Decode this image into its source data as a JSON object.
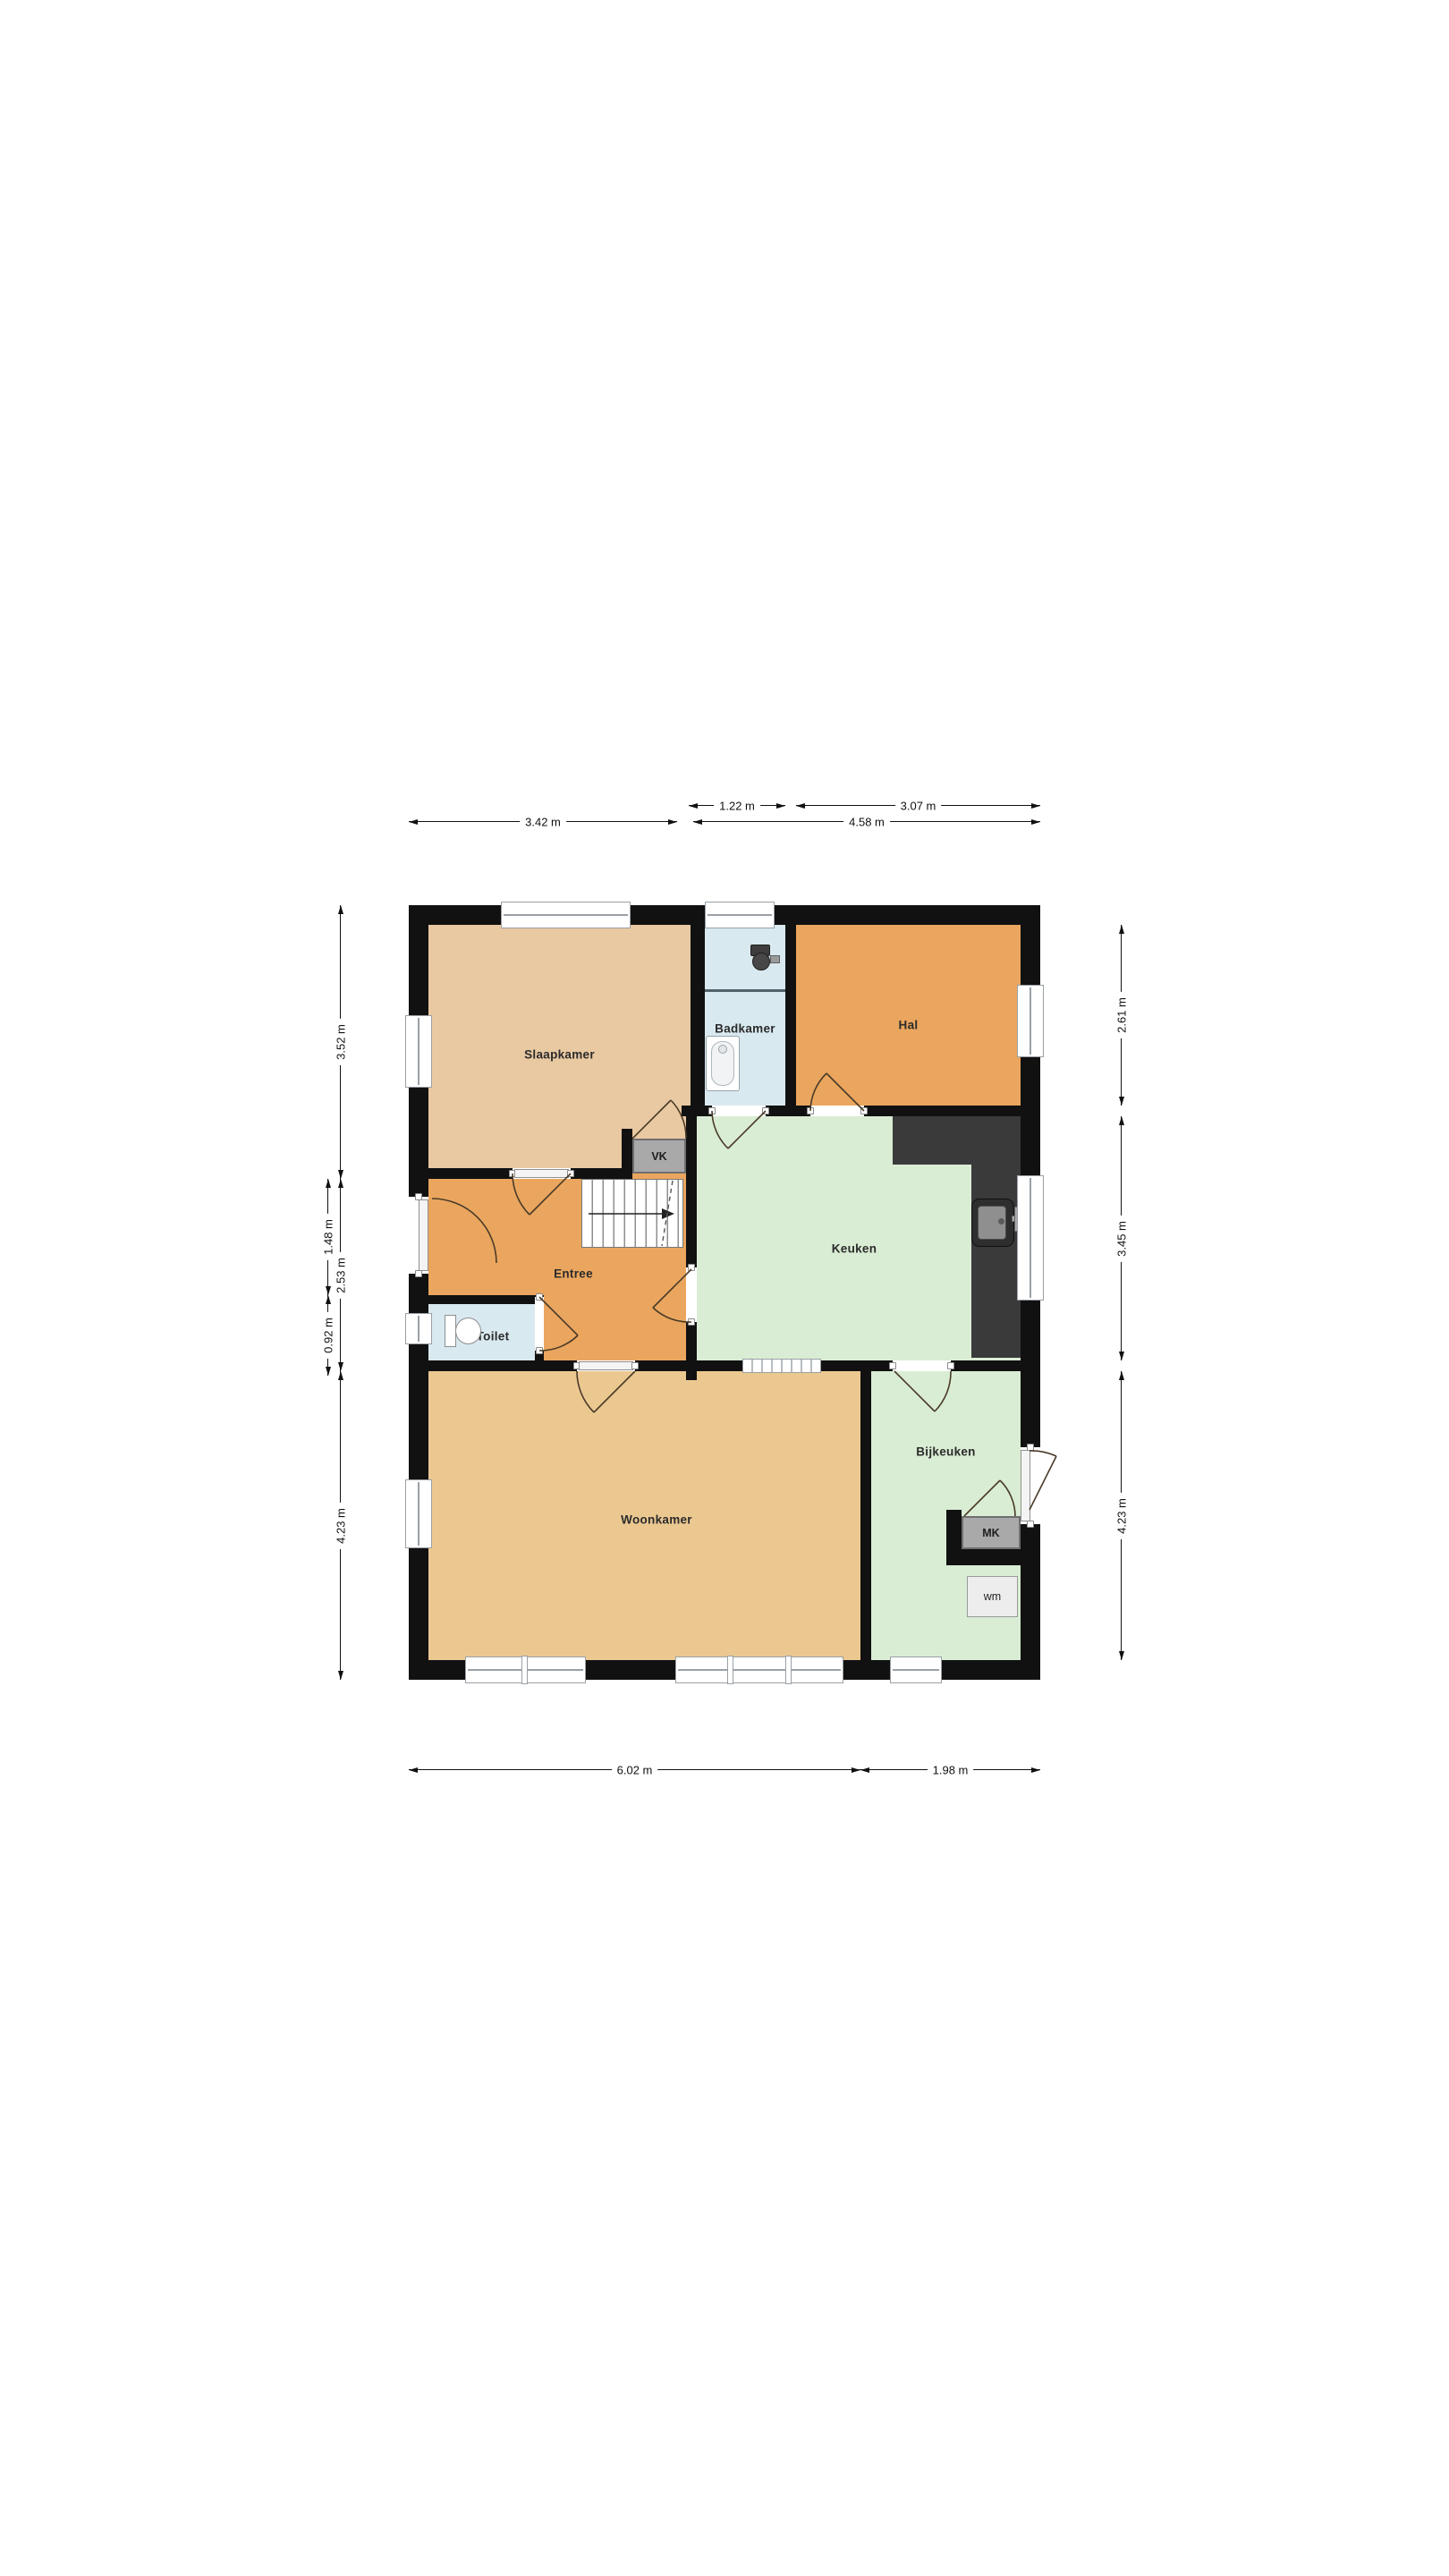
{
  "plan": {
    "kind": "floor-plan",
    "floor": "begane grond"
  },
  "rooms": {
    "slaapkamer": {
      "label": "Slaapkamer"
    },
    "badkamer": {
      "label": "Badkamer"
    },
    "hal": {
      "label": "Hal"
    },
    "keuken": {
      "label": "Keuken"
    },
    "entree": {
      "label": "Entree"
    },
    "toilet": {
      "label": "Toilet"
    },
    "woonkamer": {
      "label": "Woonkamer"
    },
    "bijkeuken": {
      "label": "Bijkeuken"
    }
  },
  "closets": {
    "vk": {
      "label": "VK"
    },
    "mk": {
      "label": "MK"
    },
    "wm": {
      "label": "wm"
    }
  },
  "dimensions": {
    "top": {
      "d122": "1.22 m",
      "d307": "3.07 m",
      "d342": "3.42 m",
      "d458": "4.58 m"
    },
    "left": {
      "d352": "3.52 m",
      "d148": "1.48 m",
      "d253": "2.53 m",
      "d092": "0.92 m",
      "d423": "4.23 m"
    },
    "right": {
      "d261": "2.61 m",
      "d345": "3.45 m",
      "d423": "4.23 m"
    },
    "bottom": {
      "d602": "6.02 m",
      "d198": "1.98 m"
    }
  },
  "icons": {
    "stairs": "stairs-icon",
    "bathtub": "bathtub-icon",
    "toilet_badkamer": "toilet-icon",
    "toilet_toiletroom": "toilet-icon",
    "sink": "kitchen-sink-icon",
    "washing_machine": "washing-machine-icon"
  },
  "colors": {
    "wall": "#111111",
    "counter": "#3a3a3a",
    "room_slaapkamer": "#e9c9a2",
    "room_woonkamer": "#ecc891",
    "room_orange": "#eaa65e",
    "room_blue": "#d9e9f0",
    "room_green": "#d9edd4",
    "closet_fill": "#a9a9a9",
    "closet_border": "#6f6f6f",
    "door_arc": "#4a3b28",
    "window_frame": "#9aa0a6",
    "dim_line": "#111111"
  }
}
